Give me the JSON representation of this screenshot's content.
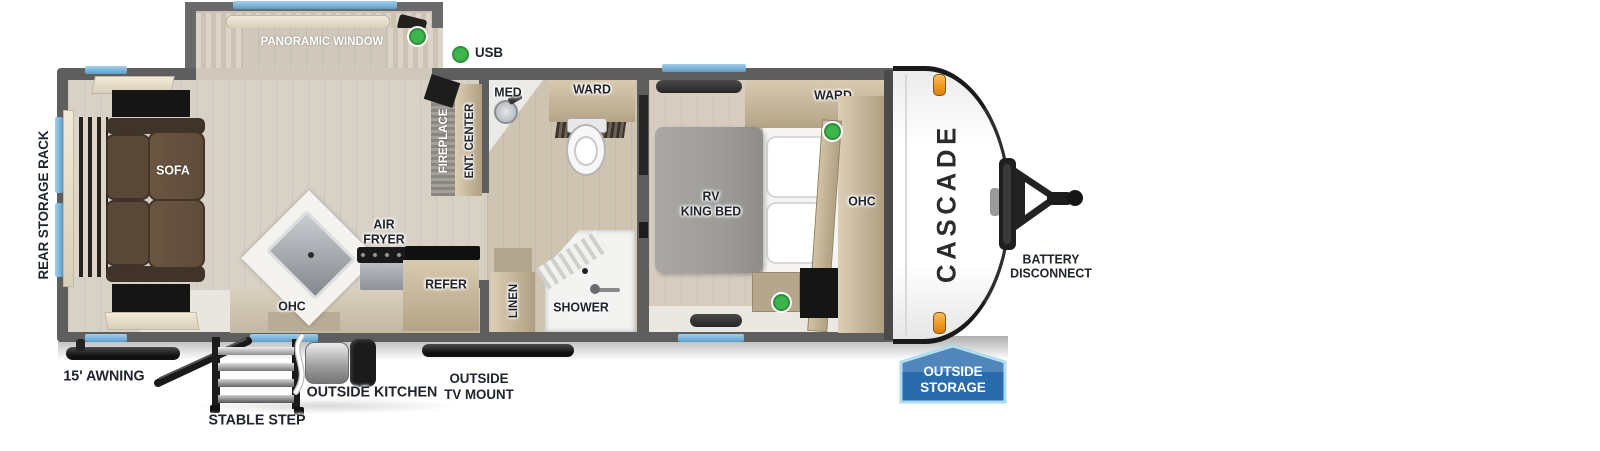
{
  "brand": {
    "name": "CASCADE"
  },
  "legend": {
    "usb": "USB"
  },
  "labels": {
    "panoramic_window": "PANORAMIC WINDOW",
    "dinette": "DINETTE",
    "sofa": "SOFA",
    "rear_storage_rack": "REAR STORAGE RACK",
    "fireplace": "FIREPLACE",
    "ent_center": "ENT. CENTER",
    "med": "MED",
    "ward_bath": "WARD",
    "ward_bedroom": "WARD",
    "rv_king_bed": [
      "RV",
      "KING BED"
    ],
    "ohc_bedroom": "OHC",
    "ohc_kitchen": "OHC",
    "air_fryer": [
      "AIR",
      "FRYER"
    ],
    "refer": "REFER",
    "linen": "LINEN",
    "shower": "SHOWER"
  },
  "exterior": {
    "awning": "15' AWNING",
    "stable_step": "STABLE STEP",
    "outside_kitchen": "OUTSIDE KITCHEN",
    "outside_tv_mount": [
      "OUTSIDE",
      "TV MOUNT"
    ],
    "outside_storage": [
      "OUTSIDE",
      "STORAGE"
    ],
    "battery_disconnect": [
      "BATTERY",
      "DISCONNECT"
    ]
  },
  "colors": {
    "wall_gray": "#5e5e5e",
    "window_blue": "#7cb5dc",
    "usb_green": "#3cb54a",
    "marker_orange": "#f0961c",
    "badge_blue": "#2a6cab",
    "badge_border": "#a9dcf0",
    "floor_living": "#d8d1c6",
    "floor_bath": "#cfc4b1",
    "floor_bedroom": "#d6cdc0",
    "sofa_brown": "#5f4b39",
    "mattress_gray": "#9e9c98"
  }
}
